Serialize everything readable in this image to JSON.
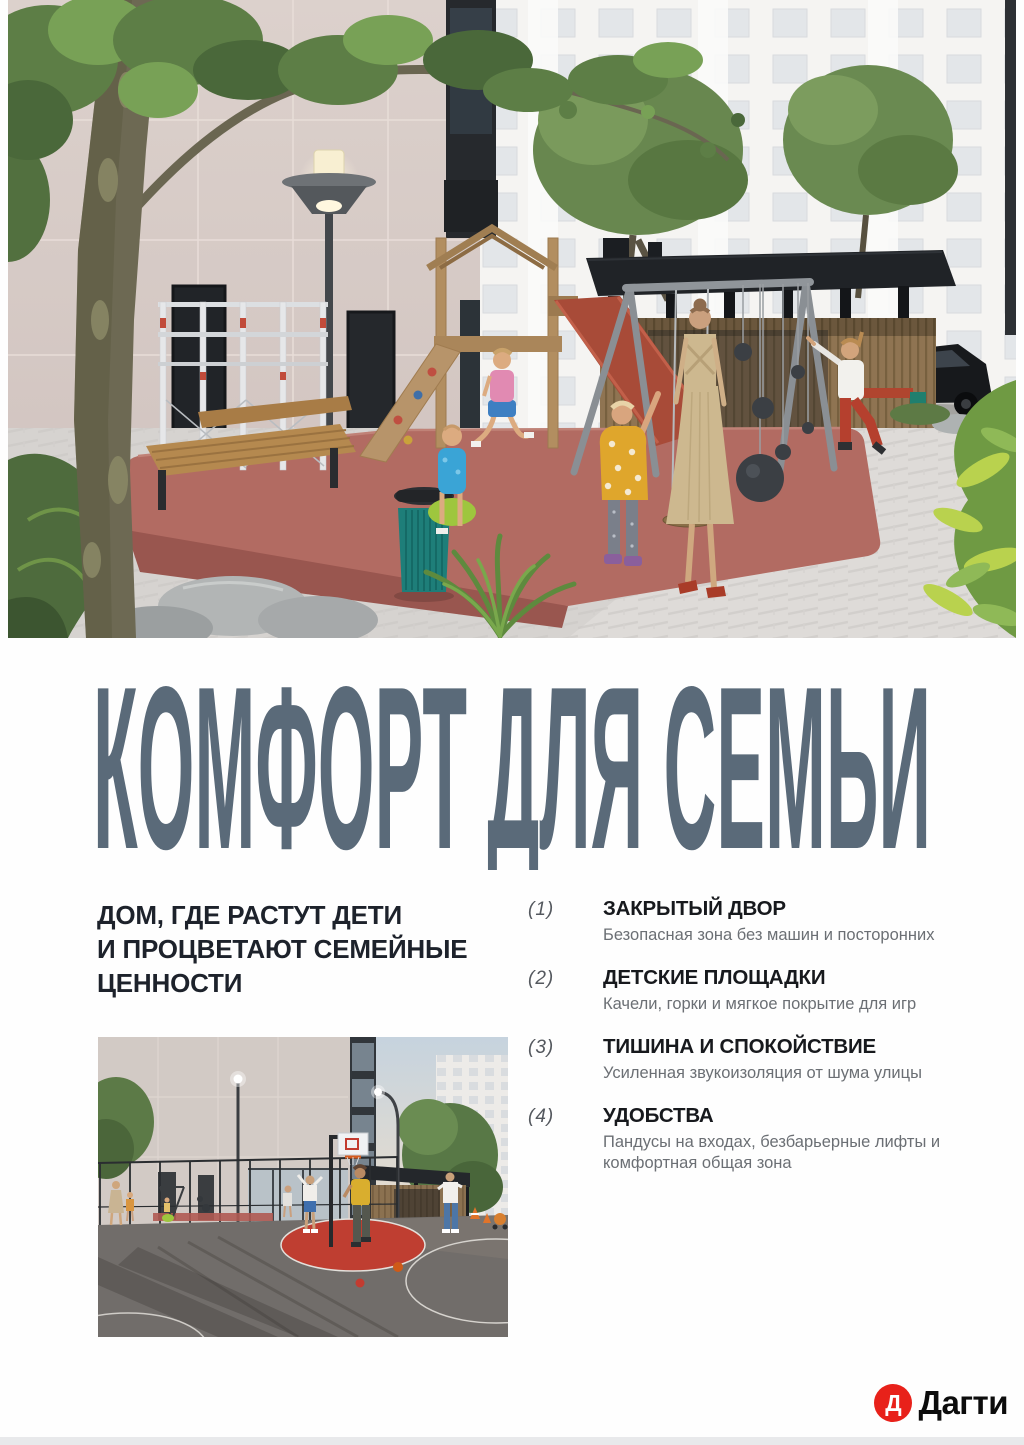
{
  "page": {
    "headline": "КОМФОРТ ДЛЯ СЕМЬИ",
    "subheadline_lines": [
      "ДОМ, ГДЕ РАСТУТ ДЕТИ",
      "И ПРОЦВЕТАЮТ СЕМЕЙНЫЕ",
      "ЦЕННОСТИ"
    ]
  },
  "features": [
    {
      "num": "(1)",
      "title": "ЗАКРЫТЫЙ ДВОР",
      "desc": "Безопасная зона без машин и посторонних"
    },
    {
      "num": "(2)",
      "title": "ДЕТСКИЕ ПЛОЩАДКИ",
      "desc": "Качели, горки и мягкое покрытие для игр"
    },
    {
      "num": "(3)",
      "title": "ТИШИНА И СПОКОЙСТВИЕ",
      "desc": "Усиленная звукоизоляция от шума улицы"
    },
    {
      "num": "(4)",
      "title": "УДОБСТВА",
      "desc": "Пандусы на входах, безбарьерные лифты и комфортная общая зона"
    }
  ],
  "logo": {
    "mark": "Д",
    "name": "Дагти"
  },
  "colors": {
    "accent_red": "#e8211a",
    "headline_slate": "#5a6a79",
    "title_dark": "#17191d",
    "desc_gray": "#6b6f74"
  }
}
